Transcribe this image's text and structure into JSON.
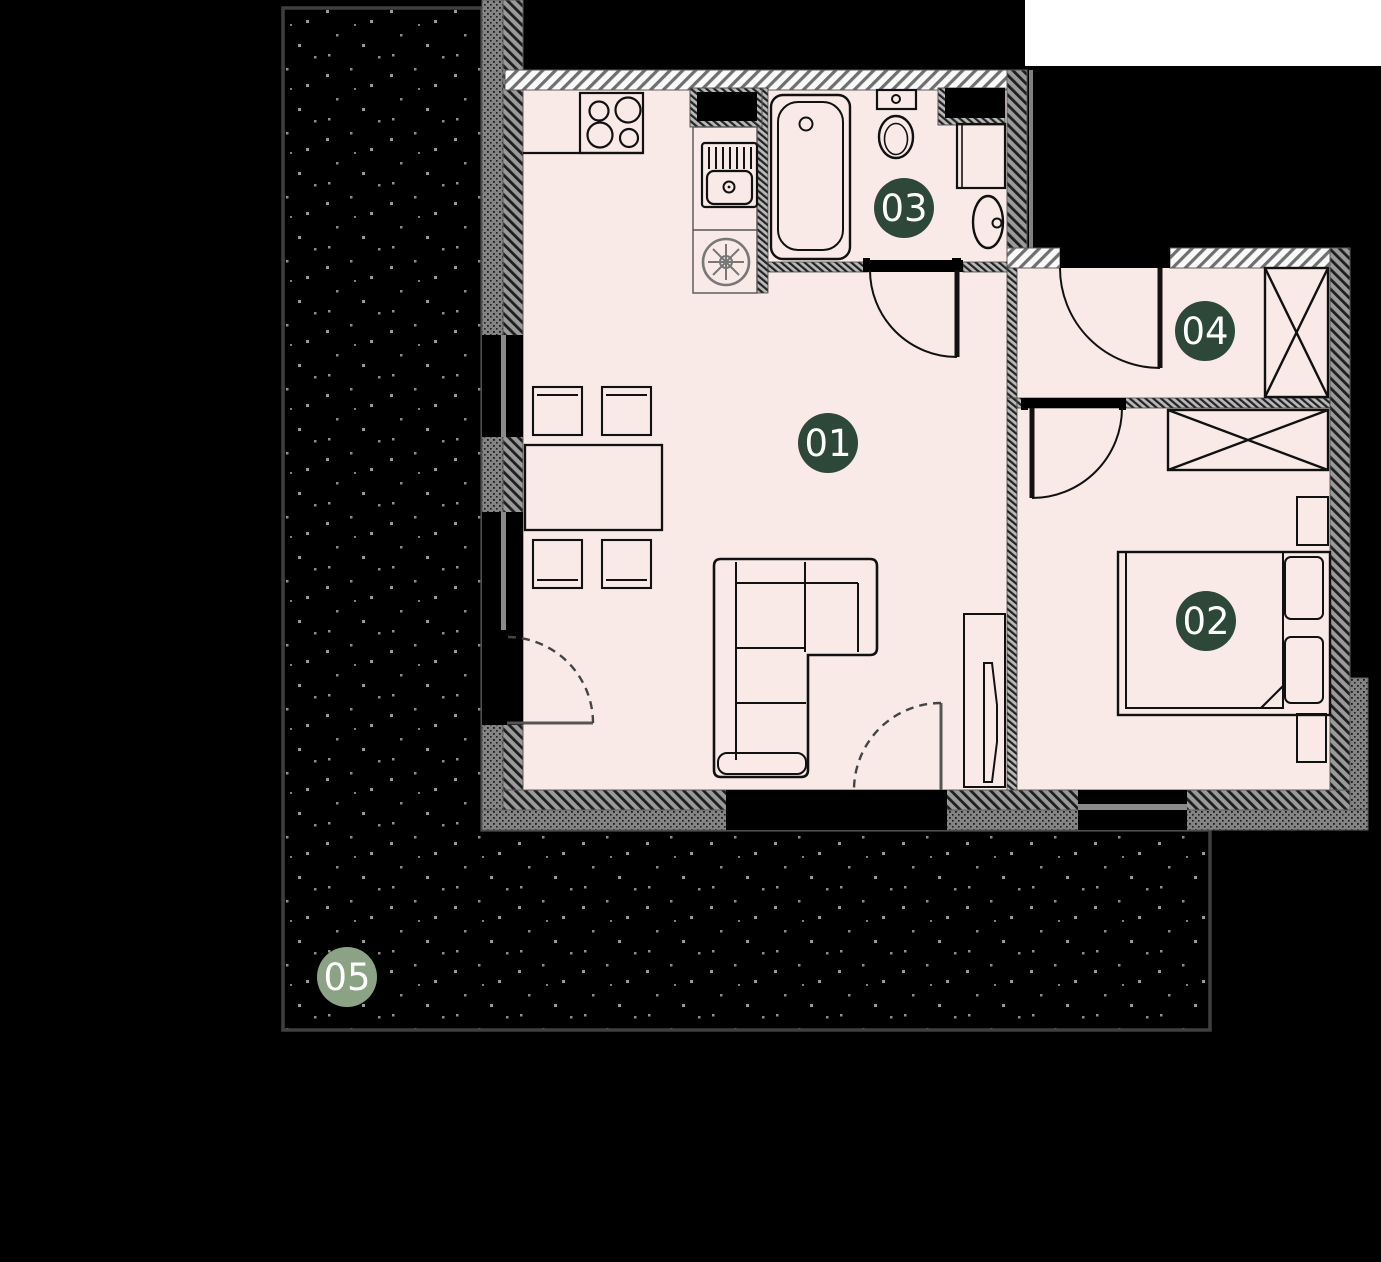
{
  "plan_title": "apartment-floor-plan",
  "colors": {
    "page_bg": "#000000",
    "corner_bg": "#ffffff",
    "floor": "#f9eae8",
    "badge_dark": "#2d4839",
    "badge_light": "#8ca284",
    "badge_text": "#ffffff",
    "terrace_dot": "#9a9a9a",
    "terrace_border": "#3f3f3f",
    "lintel": "#000000",
    "window_frame": "#8a8a8a"
  },
  "rooms": [
    {
      "label": "01",
      "cx": 828,
      "cy": 443,
      "color": "#2d4839"
    },
    {
      "label": "02",
      "cx": 1206,
      "cy": 621,
      "color": "#2d4839"
    },
    {
      "label": "03",
      "cx": 904,
      "cy": 208,
      "color": "#2d4839"
    },
    {
      "label": "04",
      "cx": 1205,
      "cy": 331,
      "color": "#2d4839"
    },
    {
      "label": "05",
      "cx": 347,
      "cy": 977,
      "color": "#8ca284"
    }
  ]
}
